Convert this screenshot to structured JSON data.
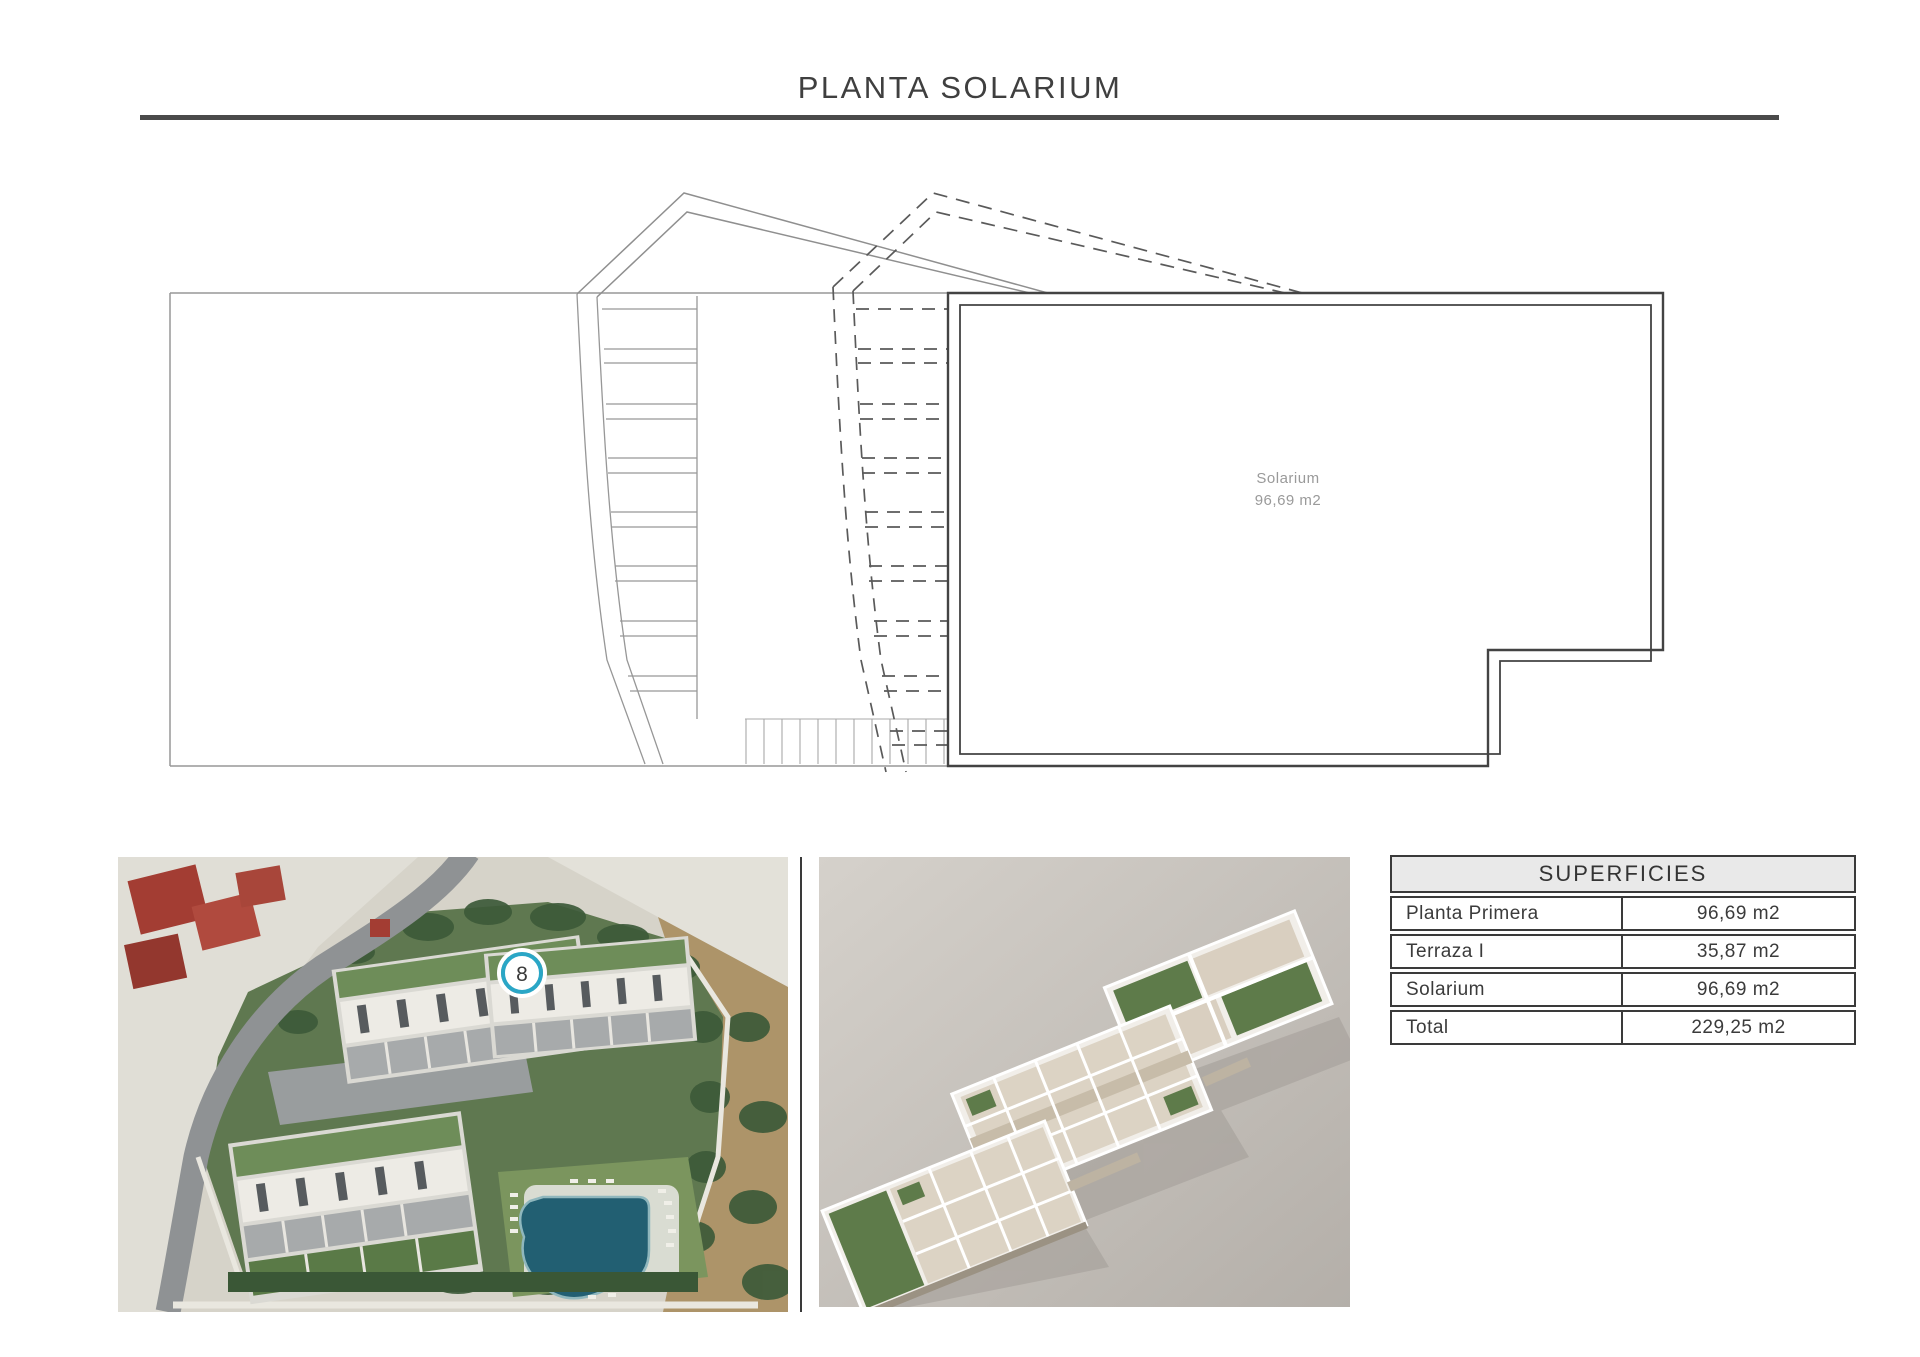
{
  "title": "PLANTA SOLARIUM",
  "plan": {
    "room": {
      "name": "Solarium",
      "area": "96,69 m2"
    }
  },
  "aerial_view": {
    "unit_badge": "8"
  },
  "superficies_table": {
    "title": "SUPERFICIES",
    "rows": [
      {
        "label": "Planta Primera",
        "value": "96,69 m2"
      },
      {
        "label": "Terraza I",
        "value": "35,87 m2"
      },
      {
        "label": "Solarium",
        "value": "96,69 m2"
      },
      {
        "label": "Total",
        "value": "229,25 m2"
      }
    ]
  },
  "colors": {
    "accent_teal": "#2aa6c6",
    "wall_dark": "#434343",
    "line_light": "#979797",
    "dashed_line": "#5a5a5a",
    "table_border": "#3a3a3a",
    "table_header_bg": "#e9e9e9",
    "pool_water": "#225f72"
  }
}
